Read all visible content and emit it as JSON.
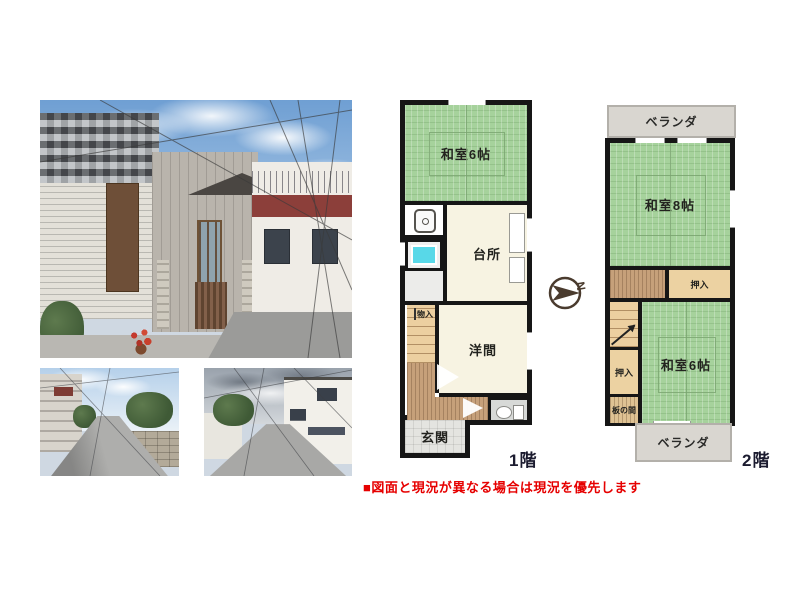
{
  "floor1": {
    "label": "1階",
    "rooms": {
      "washitsu6": "和室6帖",
      "kitchen": "台所",
      "monoire": "物入",
      "youma": "洋間",
      "genkan": "玄関"
    }
  },
  "floor2": {
    "label": "2階",
    "veranda_top": "ベランダ",
    "veranda_bottom": "ベランダ",
    "rooms": {
      "washitsu8": "和室8帖",
      "oshiire_upper": "押入",
      "oshiire_lower": "押入",
      "itanoma": "板の間",
      "washitsu6": "和室6帖"
    }
  },
  "compass": {
    "letter": "N"
  },
  "disclaimer": "■図面と現況が異なる場合は現況を優先します",
  "palette": {
    "tatami_green": "#a6d29c",
    "tatami_line": "#79a46f",
    "room_cream": "#f7f3e2",
    "wood_floor": "#c6a07a",
    "stairs_tan": "#eccfa0",
    "closet_beige": "#ecd2a2",
    "veranda_gray": "#d9d6d0",
    "tile_gray": "#e4e4e0",
    "bath_cyan": "#58d8e8",
    "wall_black": "#161616",
    "label_dark": "#1b1b2f",
    "disclaimer_red": "#e60000"
  }
}
